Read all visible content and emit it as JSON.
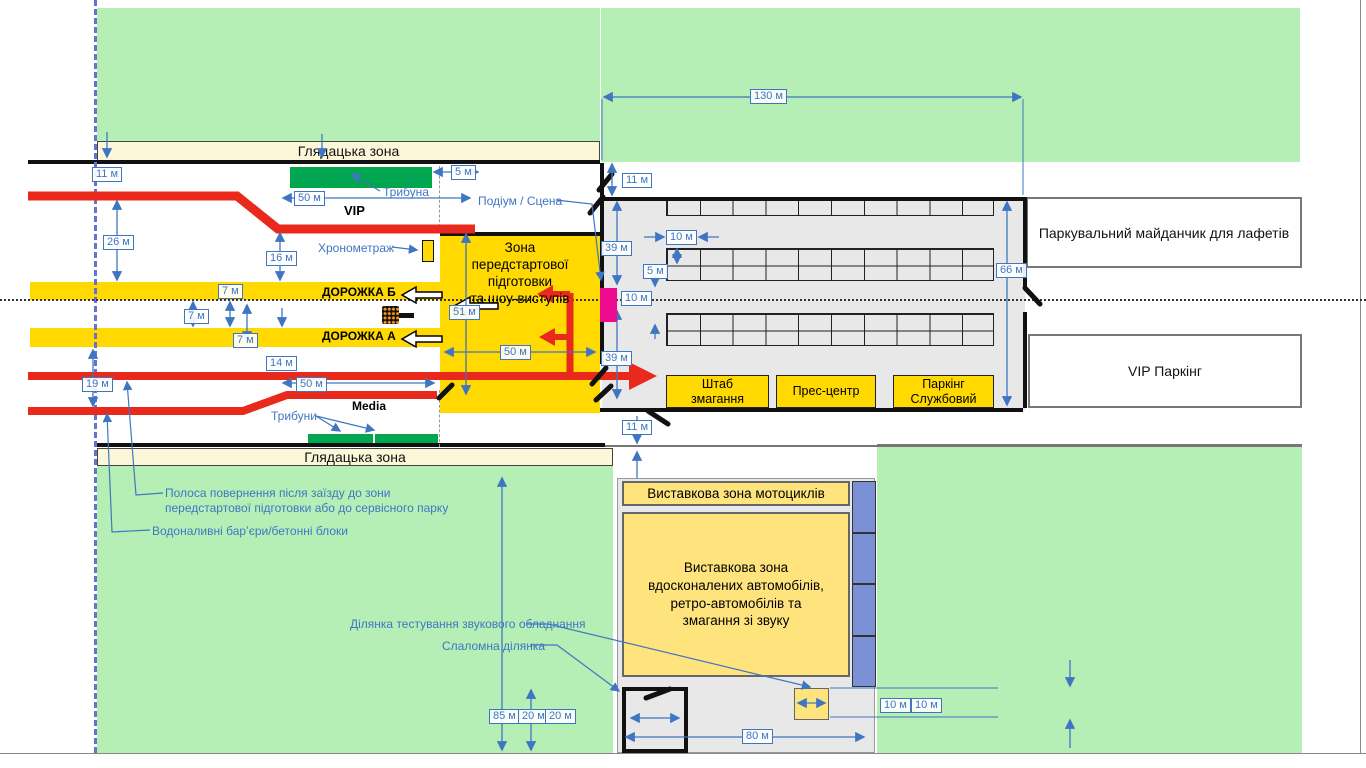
{
  "colors": {
    "green": "#b5efb6",
    "track_yellow": "#ffd900",
    "exhibit_yellow": "#ffe47e",
    "red_barrier": "#e8291c",
    "pink_podium": "#ec0a8e",
    "stand_green": "#00a651",
    "blue_dim": "#3f76c2",
    "blue_strip": "#7b90d5",
    "dashed_line": "#6672d0"
  },
  "labels": {
    "spectator_top": "Глядацька зона",
    "spectator_bottom": "Глядацька зона",
    "tribuna": "Трибуна",
    "tribuny": "Трибуни",
    "vip": "VIP",
    "media": "Media",
    "chrono": "Хронометраж",
    "podium": "Подіум / Сцена",
    "track_b": "ДОРОЖКА Б",
    "track_a": "ДОРОЖКА А",
    "prep_zone": "Зона\nпередстартової\nпідготовки\nта шоу-виступів",
    "hq": "Штаб\nзмагання",
    "press": "Прес-центр",
    "service_parking": "Паркінг\nСлужбовий",
    "trailer_parking": "Паркувальний майданчик для лафетів",
    "vip_parking": "VIP Паркінг",
    "moto_zone": "Виставкова зона мотоциклів",
    "cars_zone": "Виставкова зона\nвдосконалених автомобілів,\nретро-автомобілів та\nзмагання зі звуку",
    "return_lane": "Полоса повернення після заїзду до зони\nпередстартової підготовки або до сервісного парку",
    "water_barriers": "Водоналивні бар’єри/бетонні блоки",
    "sound_test": "Ділянка тестування звукового обладнання",
    "slalom": "Слаломна ділянка"
  },
  "plan": {
    "dim_labels": [
      {
        "t": "11 м",
        "x": 92,
        "y": 167
      },
      {
        "t": "26 м",
        "x": 103,
        "y": 235
      },
      {
        "t": "16 м",
        "x": 266,
        "y": 251
      },
      {
        "t": "50 м",
        "x": 294,
        "y": 191
      },
      {
        "t": "5 м",
        "x": 451,
        "y": 165
      },
      {
        "t": "7 м",
        "x": 218,
        "y": 284
      },
      {
        "t": "7 м",
        "x": 184,
        "y": 309
      },
      {
        "t": "7 м",
        "x": 233,
        "y": 333
      },
      {
        "t": "51 м",
        "x": 449,
        "y": 305
      },
      {
        "t": "50 м",
        "x": 500,
        "y": 345
      },
      {
        "t": "14 м",
        "x": 266,
        "y": 356
      },
      {
        "t": "19 м",
        "x": 82,
        "y": 377
      },
      {
        "t": "50 м",
        "x": 296,
        "y": 377
      },
      {
        "t": "11 м",
        "x": 622,
        "y": 173
      },
      {
        "t": "39 м",
        "x": 601,
        "y": 241
      },
      {
        "t": "10 м",
        "x": 666,
        "y": 230
      },
      {
        "t": "5 м",
        "x": 643,
        "y": 264
      },
      {
        "t": "10 м",
        "x": 621,
        "y": 291
      },
      {
        "t": "39 м",
        "x": 601,
        "y": 351
      },
      {
        "t": "130 м",
        "x": 750,
        "y": 89
      },
      {
        "t": "66 м",
        "x": 996,
        "y": 263
      },
      {
        "t": "11 м",
        "x": 622,
        "y": 420
      },
      {
        "t": "85 м",
        "x": 489,
        "y": 709
      },
      {
        "t": "20 м",
        "x": 518,
        "y": 709
      },
      {
        "t": "20 м",
        "x": 545,
        "y": 709
      },
      {
        "t": "80 м",
        "x": 742,
        "y": 729
      },
      {
        "t": "10 м",
        "x": 880,
        "y": 698
      },
      {
        "t": "10 м",
        "x": 911,
        "y": 698
      }
    ],
    "parking_grids": [
      {
        "x": 666,
        "y": 199,
        "w": 328,
        "h": 17,
        "cols": 10,
        "rows": 1
      },
      {
        "x": 666,
        "y": 248,
        "w": 328,
        "h": 33,
        "cols": 10,
        "rows": 2
      },
      {
        "x": 666,
        "y": 313,
        "w": 328,
        "h": 33,
        "cols": 10,
        "rows": 2
      }
    ],
    "trailer_strip": {
      "x": 852,
      "y": 481,
      "w": 24,
      "h": 206,
      "segments": 4
    }
  }
}
